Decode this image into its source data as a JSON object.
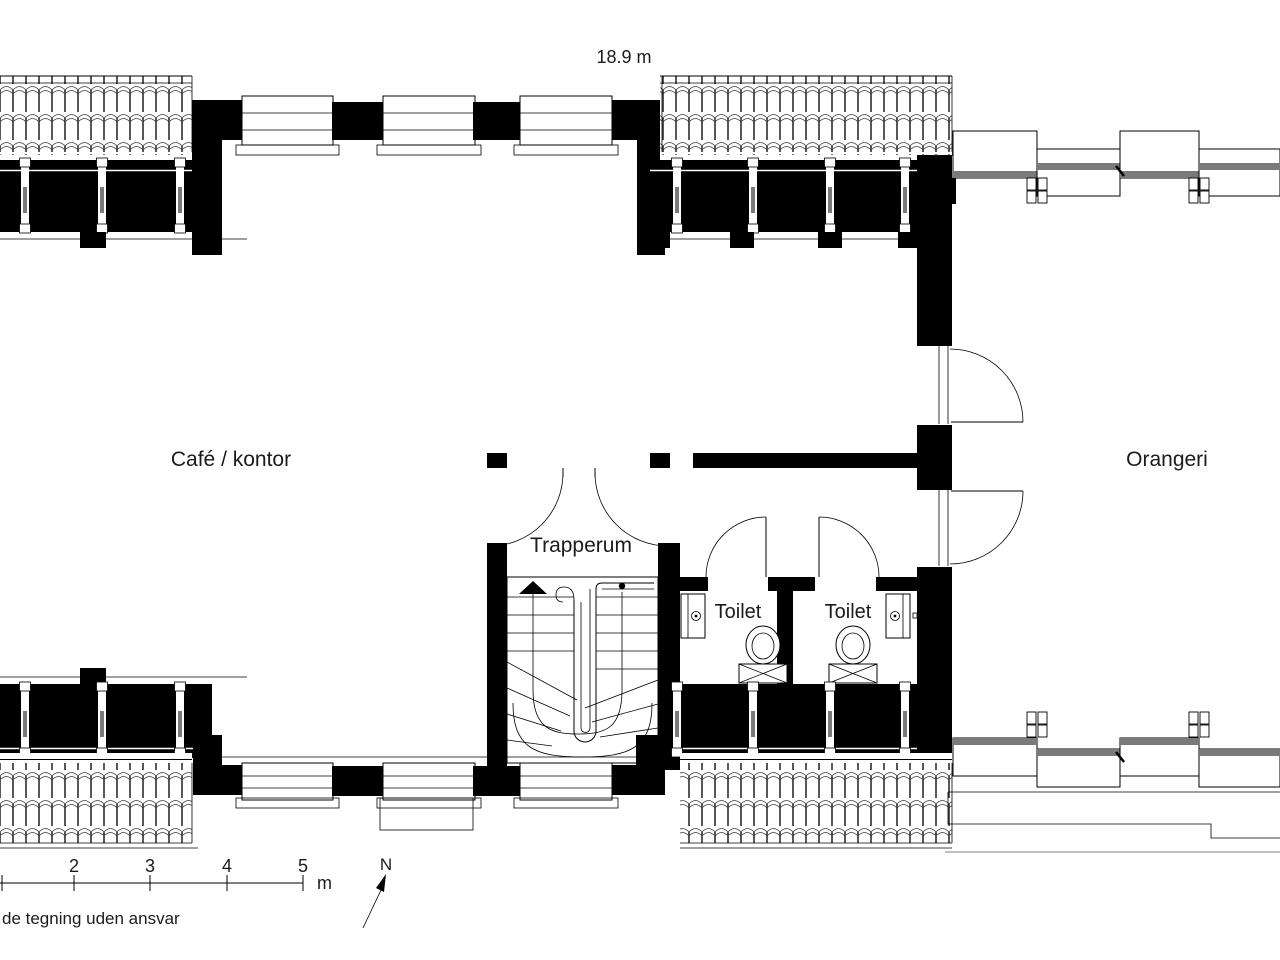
{
  "drawing": {
    "dimension_label": "18.9 m",
    "north_label": "N",
    "disclaimer": "de tegning uden ansvar"
  },
  "rooms": {
    "cafe_kontor": "Café / kontor",
    "orangeri": "Orangeri",
    "trapperum": "Trapperum",
    "toilet_left": "Toilet",
    "toilet_right": "Toilet"
  },
  "scale_bar": {
    "tick_labels": [
      "2",
      "3",
      "4",
      "5"
    ],
    "unit_label": "m"
  },
  "colors": {
    "wall": "#000000",
    "mullion_gray": "#7a7a7a",
    "faint_gray": "#9a9a9a"
  }
}
